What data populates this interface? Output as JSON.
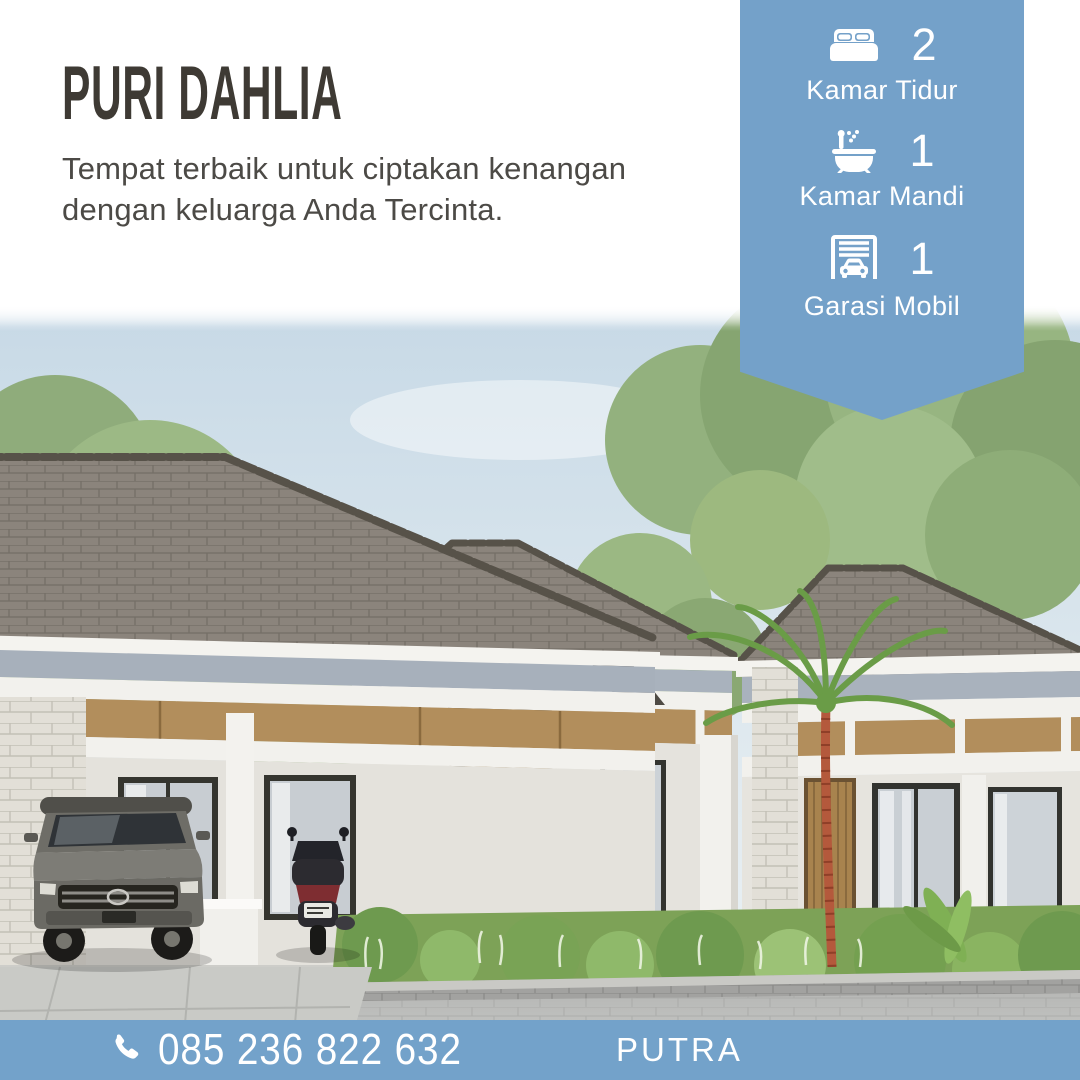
{
  "header": {
    "title": "PURI DAHLIA",
    "tagline": "Tempat terbaik untuk ciptakan kenangan dengan keluarga Anda Tercinta."
  },
  "ribbon": {
    "color": "#74A1C9",
    "items": [
      {
        "icon": "bed-icon",
        "value": "2",
        "label": "Kamar Tidur"
      },
      {
        "icon": "bath-icon",
        "value": "1",
        "label": "Kamar Mandi"
      },
      {
        "icon": "garage-icon",
        "value": "1",
        "label": "Garasi Mobil"
      }
    ]
  },
  "footer": {
    "color": "#73A2CA",
    "phone_icon": "phone-icon",
    "phone": "085 236 822 632",
    "brand": "PUTRA"
  },
  "scene": {
    "alt": "3D render of a row of modern minimalist one-storey houses with grey hip roofs, stone entry pillars, wooden doors, a grey SUV and a scooter parked in the carport, tropical trees, a palm and a small front garden behind a low stone wall"
  },
  "colors": {
    "title_text": "#3E3A34",
    "body_text": "#4C4A46",
    "accent_blue": "#74A1C9",
    "footer_blue": "#73A2CA",
    "white": "#FFFFFF"
  }
}
